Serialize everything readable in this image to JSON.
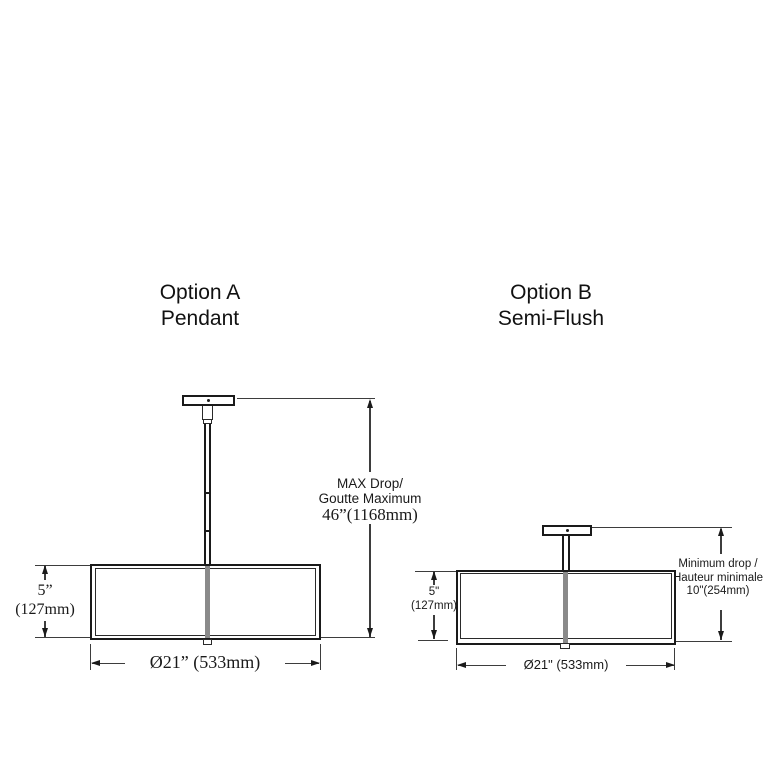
{
  "diagram": {
    "background": "#ffffff",
    "line_color": "#1a1a1a",
    "stem_color": "#8a8a8a"
  },
  "option_a": {
    "title": "Option A",
    "subtitle": "Pendant",
    "height_in": "5”",
    "height_mm": "(127mm)",
    "drop_label_1": "MAX Drop/",
    "drop_label_2": "Goutte Maximum",
    "drop_value": "46”(1168mm)",
    "diameter": "Ø21” (533mm)"
  },
  "option_b": {
    "title": "Option B",
    "subtitle": "Semi-Flush",
    "height_in": "5\"",
    "height_mm": "(127mm)",
    "drop_label_1": "Minimum drop /",
    "drop_label_2": "Hauteur minimale",
    "drop_value": "10\"(254mm)",
    "diameter": "Ø21\" (533mm)"
  }
}
